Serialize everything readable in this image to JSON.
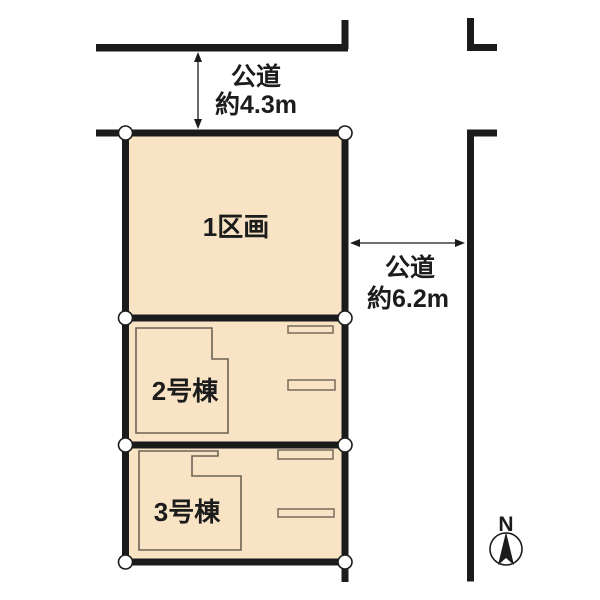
{
  "colors": {
    "lot_fill": "#f8e3c4",
    "line": "#1b1b1b",
    "building_stroke": "#6e6355",
    "text": "#1c1c1c"
  },
  "roads": {
    "top": {
      "name": "公道",
      "width": "約4.3m"
    },
    "right": {
      "name": "公道",
      "width": "約6.2m"
    }
  },
  "lots": [
    {
      "label": "1区画"
    },
    {
      "label": "2号棟"
    },
    {
      "label": "3号棟"
    }
  ],
  "compass": {
    "north": "N"
  }
}
